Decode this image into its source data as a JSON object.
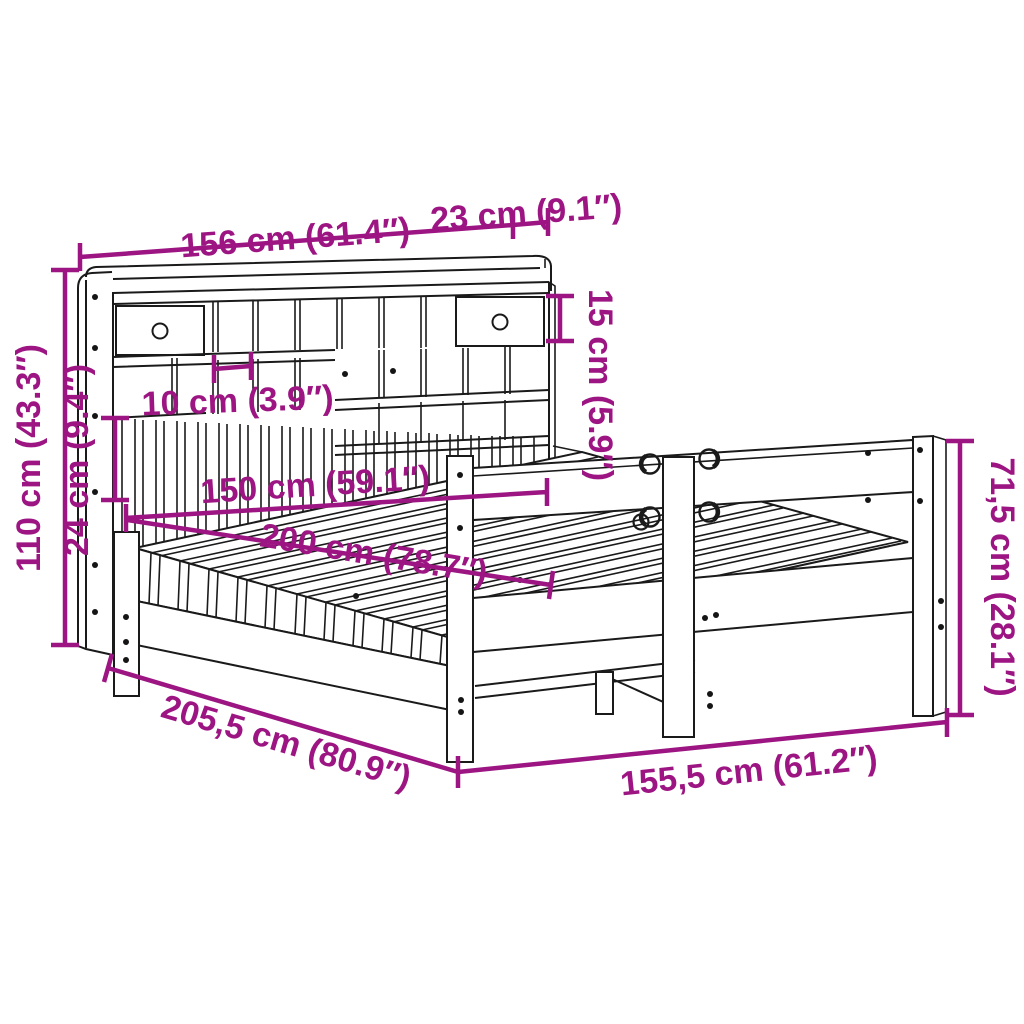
{
  "diagram": {
    "title": "Bookcase bed dimension diagram",
    "background": "#FFFFFF",
    "line_color": "#1A1A1A",
    "accent_color": "#9C1582",
    "dims": {
      "headboard_width": "156 cm (61.4″)",
      "headboard_depth": "23 cm (9.1″)",
      "shelf_clearance": "15 cm (5.9″)",
      "headboard_height": "110 cm (43.3″)",
      "shelf_depth": "24 cm (9.4″)",
      "compartment_width": "10 cm (3.9″)",
      "mattress_width": "150 cm (59.1″)",
      "mattress_length": "200 cm (78.7″)",
      "total_length": "205,5 cm (80.9″)",
      "frame_width": "155,5 cm (61.2″)",
      "footboard_height": "71,5 cm (28.1″)"
    }
  }
}
